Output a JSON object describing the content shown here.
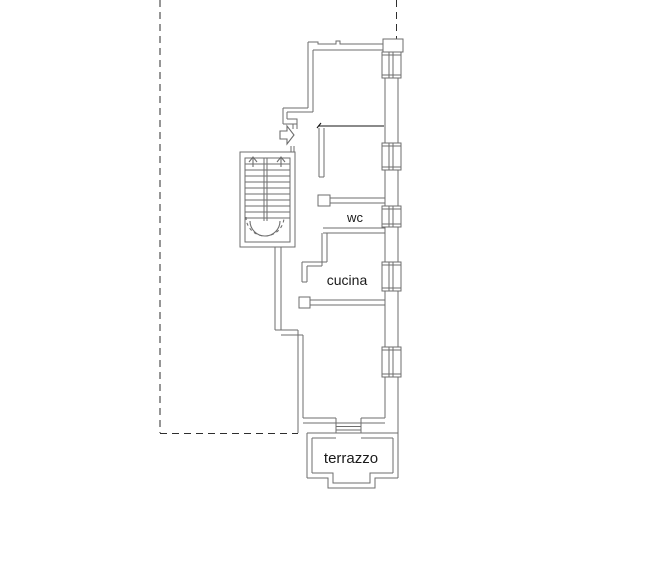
{
  "page": {
    "background": "#ffffff"
  },
  "plan": {
    "type": "apartment-floor-plan",
    "labels": {
      "wc": "wc",
      "cucina": "cucina",
      "terrazzo": "terrazzo"
    },
    "colors": {
      "wall": "#6e6e6e",
      "emphasis_wall": "#141414",
      "boundary": "#2e2e2e",
      "text": "#1a1a1a",
      "background": "#ffffff"
    },
    "symbols": [
      "staircase-symbol",
      "entry-arrow-icon",
      "window-symbol",
      "door-threshold-symbol",
      "dashed-boundary-line"
    ]
  }
}
